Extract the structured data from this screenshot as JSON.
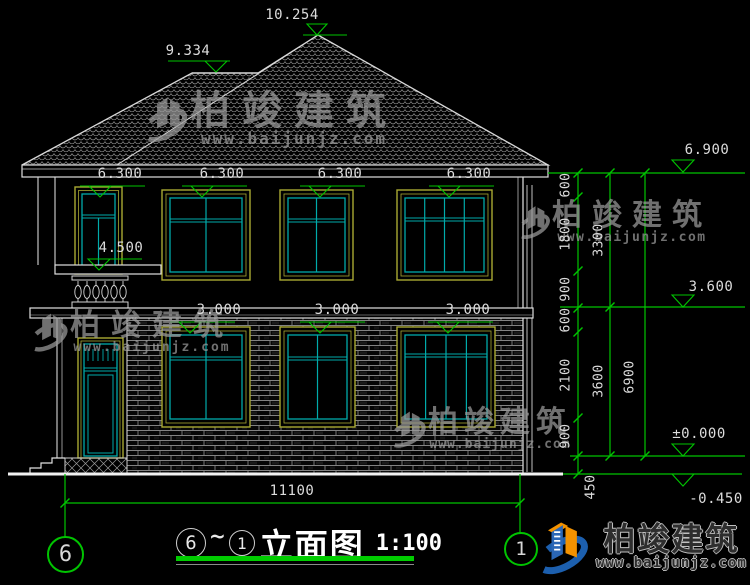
{
  "title": {
    "from_grid": "6",
    "tilde": "~",
    "to_grid": "1",
    "name": "立面图",
    "scale": "1:100"
  },
  "grid": {
    "left": "6",
    "right": "1"
  },
  "levels": {
    "peak": "10.254",
    "ridge": "9.334",
    "eave": [
      "6.300",
      "6.300",
      "6.300",
      "6.300"
    ],
    "balcony": "4.500",
    "floor1": [
      "3.000",
      "3.000",
      "3.000"
    ],
    "right_top": "6.900",
    "right_mid": "3.600",
    "right_zero": "±0.000",
    "right_below": "-0.450"
  },
  "dims": {
    "inner": [
      "600",
      "1800",
      "900",
      "600",
      "2100",
      "900"
    ],
    "inner_base": "450",
    "mid": [
      "3300",
      "3600"
    ],
    "outer": "6900",
    "width": "11100"
  },
  "watermark": {
    "brand": "柏竣建筑",
    "url": "www.baijunjz.com"
  },
  "logo": {
    "brand": "柏竣建筑",
    "url": "www.baijunjz.com"
  },
  "colors": {
    "dim_green": "#00c400",
    "frame_yellow": "#a8a832",
    "frame_cyan": "#00aaaa",
    "line_white": "#e0e0e0",
    "logo_blue": "#1c5fae",
    "logo_orange": "#f39200"
  }
}
